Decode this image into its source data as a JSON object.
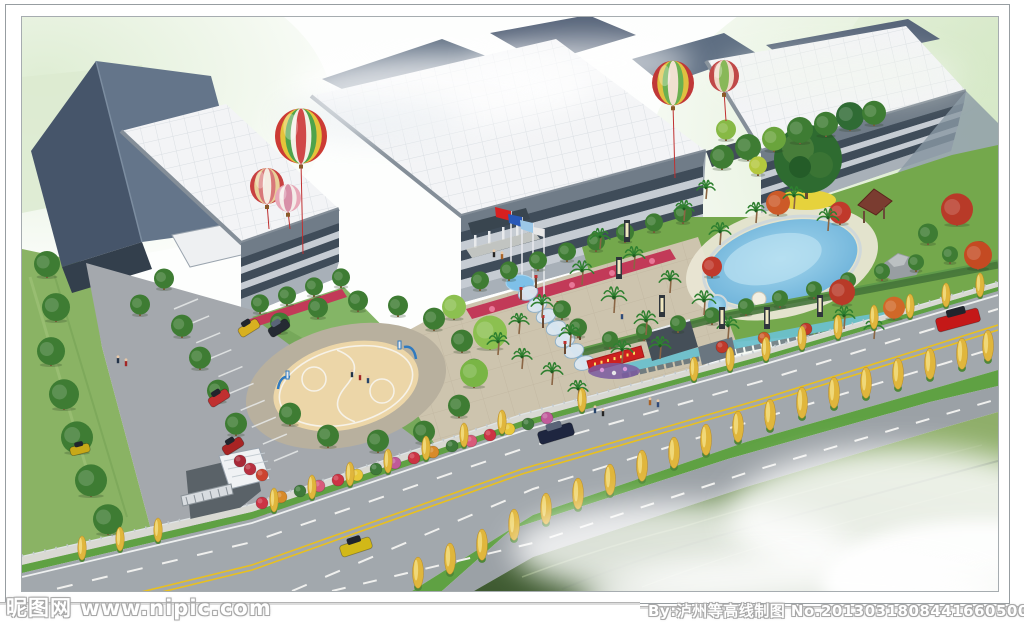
{
  "watermarks": {
    "left": "昵图网 www.nipic.com",
    "right": "By:泸州等高线制图 No.20130318084416605000"
  },
  "palette": {
    "sky_tint": "#dcecd0",
    "roof_white": "#f3f4f6",
    "roof_dark": "#5c6c80",
    "facade": "#9aa4ae",
    "window_band": "#3f4c59",
    "spandrel": "#c6ccd3",
    "road": "#a2a8ad",
    "verge_green": "#5fa143",
    "lawn": "#8ab364",
    "garden_green": "#74a84c",
    "plaza": "#cdc4ae",
    "pool_water": "#7ec3e8",
    "court": "#ecd6a8",
    "yellow_tree": "#e0b63c",
    "flag_red": "#d82020",
    "banner_red": "#cc2020",
    "center_line": "#e8c020",
    "grass_dark": "#47633a",
    "car_red": "#c41818",
    "car_yellow": "#d2b818",
    "car_dark": "#1e2640",
    "balloon_red": "#cc3b34"
  },
  "scene": {
    "balloons": [
      {
        "x": 279,
        "y": 119,
        "r": 26,
        "string": 92,
        "stripes": [
          "#cc3b34",
          "#e4c43a",
          "#4fa34b",
          "#f2efe6",
          "#d04848"
        ]
      },
      {
        "x": 245,
        "y": 169,
        "r": 17,
        "string": 26,
        "stripes": [
          "#c84040",
          "#e8d098",
          "#d87878",
          "#f4ece2"
        ]
      },
      {
        "x": 266,
        "y": 181,
        "r": 13,
        "string": 18,
        "stripes": [
          "#e8a8b8",
          "#f4ece8",
          "#d890a8"
        ]
      },
      {
        "x": 651,
        "y": 66,
        "r": 21,
        "string": 74,
        "stripes": [
          "#c03838",
          "#e0c040",
          "#6ab050",
          "#f0e0d0"
        ]
      },
      {
        "x": 702,
        "y": 59,
        "r": 15,
        "string": 30,
        "stripes": [
          "#c04848",
          "#f0d8c8",
          "#88b858"
        ]
      }
    ],
    "round_trees": [
      [
        25,
        258,
        13
      ],
      [
        34,
        302,
        14
      ],
      [
        29,
        346,
        14
      ],
      [
        42,
        390,
        15
      ],
      [
        55,
        434,
        16
      ],
      [
        69,
        477,
        16
      ],
      [
        86,
        515,
        15
      ],
      [
        160,
        318,
        11
      ],
      [
        178,
        350,
        11
      ],
      [
        196,
        383,
        11
      ],
      [
        214,
        416,
        11
      ],
      [
        118,
        296,
        10
      ],
      [
        142,
        270,
        10
      ],
      [
        258,
        314,
        10
      ],
      [
        296,
        299,
        10
      ],
      [
        336,
        292,
        10
      ],
      [
        376,
        297,
        10
      ],
      [
        412,
        311,
        11
      ],
      [
        440,
        333,
        11
      ],
      [
        452,
        362,
        11
      ],
      [
        437,
        398,
        11
      ],
      [
        402,
        424,
        11
      ],
      [
        356,
        433,
        11
      ],
      [
        306,
        428,
        11
      ],
      [
        268,
        406,
        11
      ],
      [
        458,
        271,
        9
      ],
      [
        487,
        261,
        9
      ],
      [
        516,
        251,
        9
      ],
      [
        545,
        242,
        9
      ],
      [
        574,
        232,
        9
      ],
      [
        603,
        223,
        9
      ],
      [
        632,
        213,
        9
      ],
      [
        661,
        204,
        9
      ],
      [
        238,
        294,
        9
      ],
      [
        265,
        286,
        9
      ],
      [
        292,
        277,
        9
      ],
      [
        319,
        268,
        9
      ],
      [
        588,
        329,
        8
      ],
      [
        622,
        321,
        8
      ],
      [
        656,
        313,
        8
      ],
      [
        690,
        305,
        8
      ],
      [
        724,
        296,
        8
      ],
      [
        758,
        288,
        8
      ],
      [
        792,
        279,
        8
      ],
      [
        826,
        270,
        8
      ],
      [
        860,
        261,
        8
      ],
      [
        894,
        252,
        8
      ],
      [
        928,
        244,
        8
      ],
      [
        958,
        237,
        7
      ],
      [
        700,
        150,
        12
      ],
      [
        726,
        141,
        13
      ],
      [
        752,
        132,
        12,
        "#6aa43c"
      ],
      [
        778,
        124,
        13
      ],
      [
        804,
        117,
        12
      ],
      [
        828,
        111,
        14,
        "#2f6b34"
      ],
      [
        852,
        106,
        12
      ],
      [
        704,
        121,
        10,
        "#87b945"
      ],
      [
        736,
        156,
        9,
        "#b4c83e"
      ],
      [
        935,
        206,
        16,
        "#b83a28"
      ],
      [
        956,
        250,
        14,
        "#c44a22"
      ],
      [
        820,
        286,
        13,
        "#b83a28"
      ],
      [
        756,
        196,
        12,
        "#cc5a28"
      ],
      [
        872,
        300,
        11,
        "#d06828"
      ],
      [
        690,
        258,
        10,
        "#c0392b"
      ],
      [
        818,
        205,
        11,
        "#c0392b"
      ],
      [
        468,
        330,
        17,
        "#8cc050"
      ],
      [
        452,
        368,
        14,
        "#79b545"
      ],
      [
        432,
        300,
        12,
        "#8cc050"
      ],
      [
        556,
        318,
        9
      ],
      [
        540,
        300,
        9
      ],
      [
        906,
        225,
        10,
        "#3e7c33"
      ]
    ],
    "palms": [
      [
        560,
        268,
        13
      ],
      [
        592,
        296,
        14
      ],
      [
        624,
        318,
        13
      ],
      [
        578,
        232,
        11
      ],
      [
        612,
        252,
        12
      ],
      [
        648,
        276,
        12
      ],
      [
        682,
        298,
        13
      ],
      [
        706,
        322,
        12
      ],
      [
        662,
        204,
        11
      ],
      [
        698,
        228,
        12
      ],
      [
        734,
        206,
        11
      ],
      [
        772,
        192,
        12
      ],
      [
        806,
        214,
        12
      ],
      [
        684,
        182,
        10
      ],
      [
        822,
        312,
        12
      ],
      [
        852,
        322,
        11
      ],
      [
        638,
        342,
        12
      ],
      [
        600,
        346,
        12
      ],
      [
        548,
        330,
        12
      ],
      [
        520,
        300,
        12
      ],
      [
        497,
        317,
        11
      ],
      [
        476,
        338,
        12
      ],
      [
        500,
        352,
        11
      ],
      [
        530,
        368,
        12
      ],
      [
        556,
        384,
        11
      ]
    ],
    "yellow_trees_row1": [
      [
        60,
        542
      ],
      [
        98,
        533
      ],
      [
        136,
        524
      ],
      [
        252,
        494
      ],
      [
        290,
        481
      ],
      [
        328,
        468
      ],
      [
        366,
        455
      ],
      [
        404,
        442
      ],
      [
        442,
        429
      ],
      [
        480,
        416
      ],
      [
        560,
        394
      ],
      [
        672,
        363
      ],
      [
        708,
        353
      ],
      [
        744,
        343
      ],
      [
        780,
        332
      ],
      [
        816,
        321
      ],
      [
        852,
        311
      ],
      [
        888,
        300
      ],
      [
        924,
        289
      ],
      [
        958,
        279
      ]
    ],
    "yellow_trees_row2": [
      [
        396,
        570
      ],
      [
        428,
        556
      ],
      [
        460,
        542
      ],
      [
        492,
        522
      ],
      [
        524,
        506
      ],
      [
        556,
        491
      ],
      [
        588,
        477
      ],
      [
        620,
        463
      ],
      [
        652,
        450
      ],
      [
        684,
        437
      ],
      [
        716,
        424
      ],
      [
        748,
        412
      ],
      [
        780,
        400
      ],
      [
        812,
        390
      ],
      [
        844,
        380
      ],
      [
        876,
        371
      ],
      [
        908,
        361
      ],
      [
        940,
        351
      ],
      [
        966,
        343
      ]
    ],
    "bushes": [
      [
        240,
        486,
        "#cc3344"
      ],
      [
        259,
        480,
        "#d88a2a"
      ],
      [
        278,
        474,
        "#3e7a3a"
      ],
      [
        297,
        469,
        "#d85a7a"
      ],
      [
        316,
        463,
        "#cc3344"
      ],
      [
        335,
        458,
        "#e8c83a"
      ],
      [
        354,
        452,
        "#3e7a3a"
      ],
      [
        373,
        446,
        "#c05a9a"
      ],
      [
        392,
        441,
        "#cc3344"
      ],
      [
        411,
        435,
        "#d88a2a"
      ],
      [
        430,
        429,
        "#3e7a3a"
      ],
      [
        449,
        424,
        "#d85a7a"
      ],
      [
        468,
        418,
        "#cc3344"
      ],
      [
        487,
        412,
        "#e8c83a"
      ],
      [
        506,
        407,
        "#3e7a3a"
      ],
      [
        525,
        401,
        "#c05a9a"
      ],
      [
        228,
        452,
        "#b83040"
      ],
      [
        240,
        458,
        "#cc4430"
      ],
      [
        218,
        444,
        "#a82838"
      ],
      [
        700,
        330,
        "#c0392b"
      ],
      [
        742,
        321,
        "#cc5a28"
      ],
      [
        784,
        312,
        "#c0392b"
      ]
    ],
    "cars_road": [
      {
        "x": 914,
        "y": 296,
        "w": 44,
        "h": 14,
        "a": -15,
        "c": "#c41818"
      },
      {
        "x": 516,
        "y": 410,
        "w": 36,
        "h": 13,
        "a": -17,
        "c": "#1e2640"
      },
      {
        "x": 318,
        "y": 524,
        "w": 32,
        "h": 12,
        "a": -18,
        "c": "#d2b818"
      }
    ],
    "cars_parked": [
      {
        "x": 216,
        "y": 306,
        "w": 22,
        "h": 10,
        "a": -32,
        "c": "#d8b020"
      },
      {
        "x": 246,
        "y": 306,
        "w": 22,
        "h": 10,
        "a": -32,
        "c": "#252a33"
      },
      {
        "x": 186,
        "y": 376,
        "w": 22,
        "h": 10,
        "a": -32,
        "c": "#c03030"
      },
      {
        "x": 200,
        "y": 424,
        "w": 22,
        "h": 10,
        "a": -32,
        "c": "#a82424"
      },
      {
        "x": 48,
        "y": 428,
        "w": 20,
        "h": 9,
        "a": -14,
        "c": "#c8a818"
      }
    ],
    "people": [
      [
        96,
        346
      ],
      [
        104,
        349
      ],
      [
        573,
        396
      ],
      [
        581,
        399
      ],
      [
        628,
        388
      ],
      [
        636,
        390
      ],
      [
        330,
        360
      ],
      [
        338,
        363
      ],
      [
        346,
        366
      ],
      [
        472,
        240
      ],
      [
        480,
        242
      ],
      [
        600,
        302
      ]
    ],
    "lamps": [
      [
        605,
        225
      ],
      [
        597,
        262
      ],
      [
        640,
        300
      ],
      [
        700,
        312
      ],
      [
        745,
        312
      ],
      [
        798,
        300
      ]
    ],
    "parking_stalls": {
      "x1": 152,
      "y1": 292,
      "x2": 252,
      "y2": 444,
      "n": 9,
      "tx": 24,
      "ty": -10
    }
  }
}
